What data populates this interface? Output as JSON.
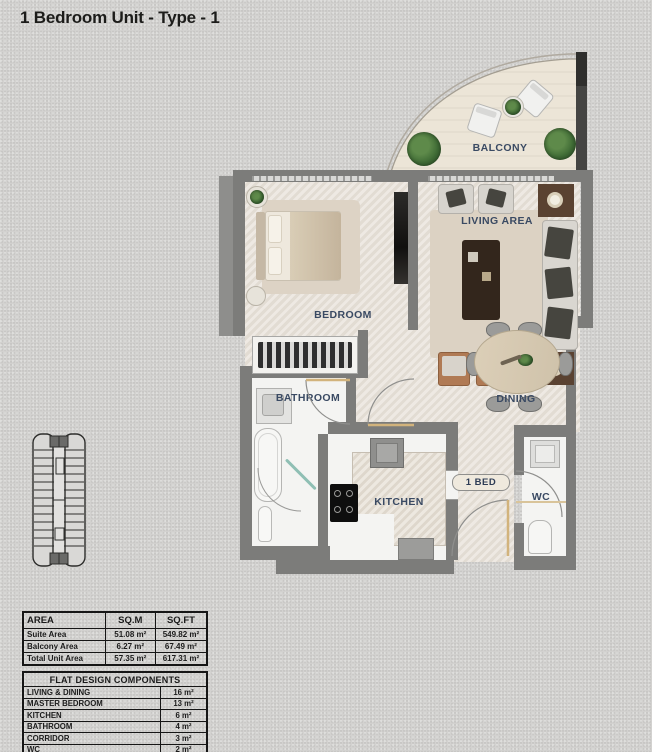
{
  "title": "1 Bedroom Unit - Type - 1",
  "plan": {
    "labels": {
      "balcony": "BALCONY",
      "living": "LIVING AREA",
      "bedroom": "BEDROOM",
      "bathroom": "BATHROOM",
      "dining": "DINING",
      "kitchen": "KITCHEN",
      "wc": "WC",
      "bed_badge": "1 BED"
    }
  },
  "area_table": {
    "headers": [
      "AREA",
      "SQ.M",
      "SQ.FT"
    ],
    "rows": [
      {
        "label": "Suite Area",
        "sqm": "51.08 m²",
        "sqft": "549.82 m²"
      },
      {
        "label": "Balcony Area",
        "sqm": "6.27 m²",
        "sqft": "67.49 m²"
      },
      {
        "label": "Total Unit Area",
        "sqm": "57.35 m²",
        "sqft": "617.31 m²"
      }
    ]
  },
  "components_table": {
    "header": "FLAT DESIGN COMPONENTS",
    "rows": [
      {
        "label": "LIVING & DINING",
        "value": "16 m²"
      },
      {
        "label": "MASTER BEDROOM",
        "value": "13 m²"
      },
      {
        "label": "KITCHEN",
        "value": "6 m²"
      },
      {
        "label": "BATHROOM",
        "value": "4 m²"
      },
      {
        "label": "CORRIDOR",
        "value": "3 m²"
      },
      {
        "label": "WC",
        "value": "2 m²"
      }
    ]
  },
  "colors": {
    "background": "#d3d2d0",
    "wall": "#7c7c7a",
    "floor_beige": "#e7e1d8",
    "floor_white": "#f4f4f2",
    "balcony_floor": "#ece5d7",
    "label_text": "#3a4a63",
    "table_border": "#161616",
    "door_leaf": "#d2b37c"
  }
}
